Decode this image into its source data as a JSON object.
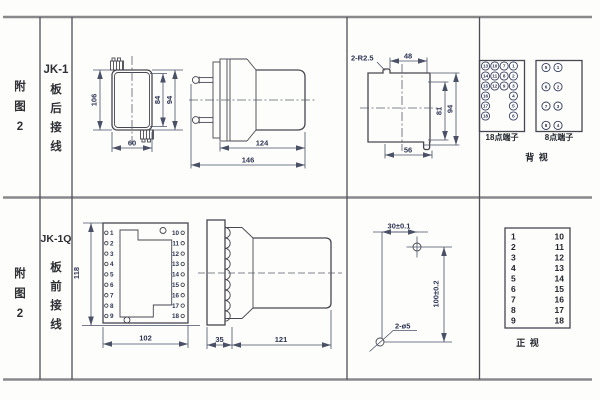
{
  "r1": {
    "fig": [
      "附",
      "图",
      "2"
    ],
    "model": "JK-1",
    "title": [
      "板",
      "后",
      "接",
      "线"
    ],
    "front": {
      "h": "106",
      "w": "60",
      "d1": "84",
      "d2": "94"
    },
    "side": {
      "body": "124",
      "total": "146"
    },
    "cut": {
      "r": "2-R2.5",
      "top": "48",
      "inner": "81",
      "outer": "94",
      "bottom": "56"
    },
    "t18": {
      "label": "18点端子",
      "c1": [
        "13",
        "14",
        "15",
        "16",
        "17",
        "18"
      ],
      "c2": [
        "10",
        "11",
        "12"
      ],
      "c3": [
        "7",
        "8",
        "9"
      ],
      "c4": [
        "1",
        "2",
        "3",
        "4",
        "5",
        "6"
      ]
    },
    "t8": {
      "label": "8点端子",
      "l": [
        "5",
        "6",
        "7",
        "8"
      ],
      "r": [
        "1",
        "2",
        "3",
        "4"
      ]
    },
    "view": "背  视"
  },
  "r2": {
    "fig": [
      "附",
      "图",
      "2"
    ],
    "model": "JK-1Q",
    "title": [
      "板",
      "前",
      "接",
      "线"
    ],
    "front": {
      "h": "118",
      "w": "102",
      "left": [
        "1",
        "2",
        "3",
        "4",
        "5",
        "6",
        "7",
        "8",
        "9"
      ],
      "right": [
        "10",
        "11",
        "12",
        "13",
        "14",
        "15",
        "16",
        "17",
        "18"
      ]
    },
    "side": {
      "flange": "35",
      "body": "121"
    },
    "drill": {
      "dx": "30±0.1",
      "dy": "100±0.2",
      "holes": "2-ø5"
    },
    "table": {
      "left": [
        "1",
        "2",
        "3",
        "4",
        "5",
        "6",
        "7",
        "8",
        "9"
      ],
      "right": [
        "10",
        "11",
        "12",
        "13",
        "14",
        "15",
        "16",
        "17",
        "18"
      ],
      "view": "正  视"
    }
  }
}
